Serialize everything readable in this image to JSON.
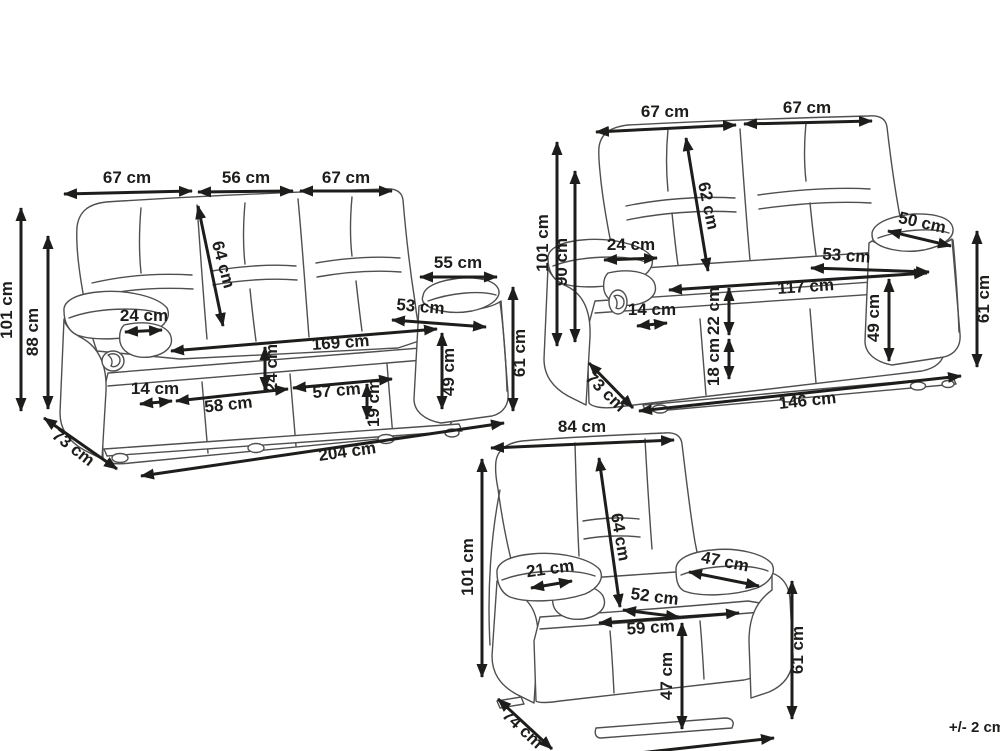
{
  "colors": {
    "background": "#ffffff",
    "dimension_lines": "#1d1d1b",
    "furniture_lines": "#4f4f4f"
  },
  "tolerance_note": "+/- 2 cm",
  "three_seater_sofa": {
    "dimensions": {
      "back_section_left": "67 cm",
      "back_section_middle": "56 cm",
      "back_section_right": "67 cm",
      "backrest_height": "64 cm",
      "overall_height": "101 cm",
      "back_height": "88 cm",
      "armrest_width": "24 cm",
      "armrest_length": "55 cm",
      "seat_depth": "53 cm",
      "inner_width": "169 cm",
      "seat_cushion_thickness": "24 cm",
      "armrest_base_width": "14 cm",
      "seat_section_left": "58 cm",
      "seat_section_right": "57 cm",
      "base_height": "19 cm",
      "seat_height": "49 cm",
      "armrest_height": "61 cm",
      "overall_depth": "73 cm",
      "overall_width": "204 cm"
    }
  },
  "two_seater_sofa": {
    "dimensions": {
      "back_section_left": "67 cm",
      "back_section_right": "67 cm",
      "backrest_height": "62 cm",
      "overall_height": "101 cm",
      "back_height": "90 cm",
      "armrest_width": "24 cm",
      "armrest_base_width": "14 cm",
      "seat_cushion_thickness": "22 cm",
      "base_height": "18 cm",
      "inner_width": "117 cm",
      "seat_depth": "53 cm",
      "armrest_length": "50 cm",
      "seat_height": "49 cm",
      "armrest_height": "61 cm",
      "overall_depth": "73 cm",
      "overall_width": "146 cm"
    }
  },
  "armchair": {
    "dimensions": {
      "back_width": "84 cm",
      "backrest_height": "64 cm",
      "overall_height": "101 cm",
      "armrest_width": "21 cm",
      "seat_depth": "52 cm",
      "seat_width": "59 cm",
      "armrest_length": "47 cm",
      "seat_height": "47 cm",
      "armrest_height": "61 cm",
      "overall_depth": "74 cm"
    }
  }
}
